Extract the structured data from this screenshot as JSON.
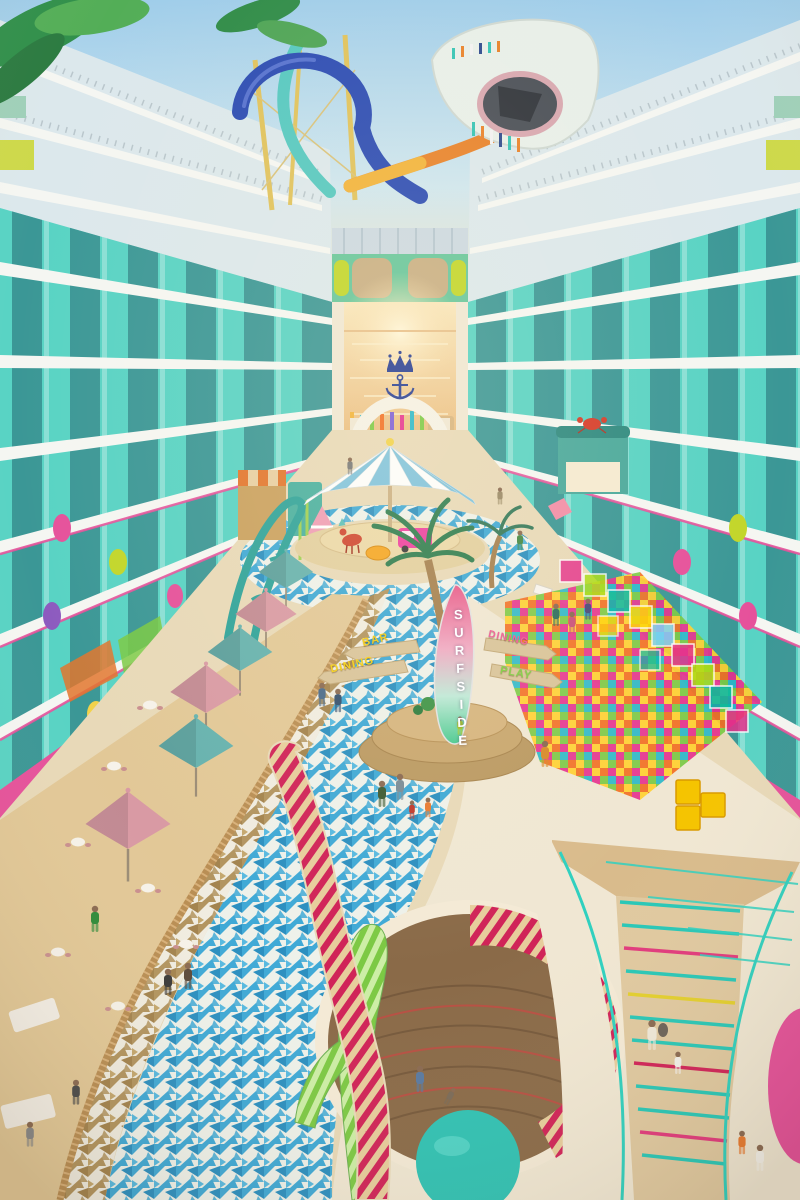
{
  "scene": {
    "title": "Cruise ship Surfside neighborhood atrium rendering",
    "signage": {
      "surfboard": "SURFSIDE",
      "left_bar": "BAR",
      "left_dining": "DINING",
      "right_dining": "DINING",
      "right_play": "PLAY"
    },
    "logo": {
      "name": "crown-and-anchor",
      "color": "#233a92"
    },
    "palette": {
      "sky": "#a9d3ec",
      "sunset": "#f6e3c2",
      "ocean_gold": "#eec27f",
      "balcony_teal": "#58d3c4",
      "slab_white": "#f5f6f2",
      "accent_magenta": "#e6519b",
      "accent_lime": "#c2d629",
      "mosaic_blue": "#3fa9d6",
      "mosaic_tan": "#b2945f",
      "deck_sand": "#e8d9b8",
      "umbrella_pink": "#d99aa4",
      "umbrella_teal": "#66b2ae",
      "stripe_red": "#d02358",
      "stripe_green": "#7cc944",
      "stair_teal": "#2fd0bf",
      "carousel_blue": "#7fc3dd",
      "slide_blue": "#2b4bb3",
      "slide_orange": "#e8822a"
    },
    "elements": [
      "water-slides",
      "balcony-walls",
      "ocean-arch-logo",
      "carousel-umbrella",
      "surfside-signpost",
      "dining-terrace",
      "play-zone",
      "mosaic-walkway",
      "ribbon-sculpture",
      "lower-deck-opening",
      "curved-staircase"
    ]
  }
}
